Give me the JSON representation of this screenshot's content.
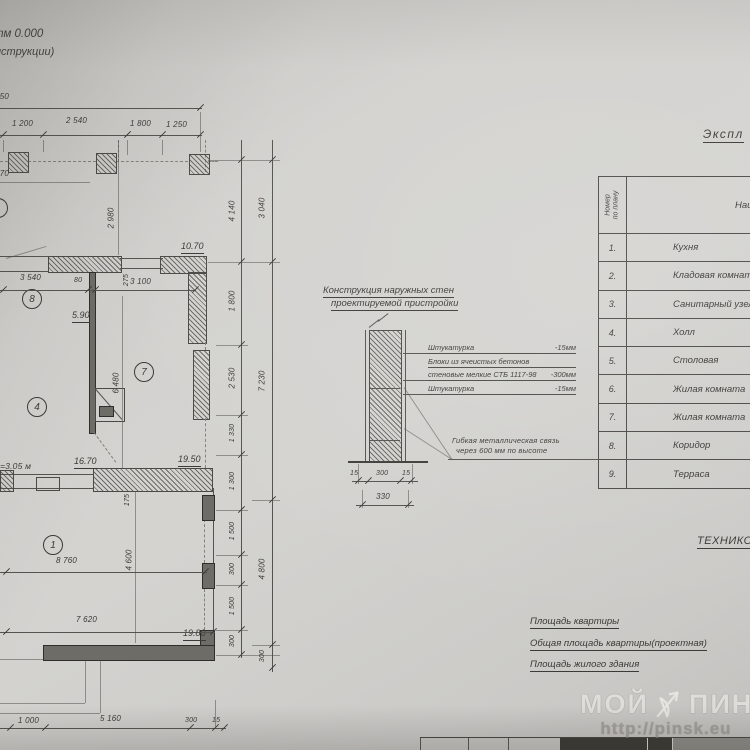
{
  "plan": {
    "elev_line1": "тм 0.000",
    "elev_line2": "нструкции)",
    "height_note": "=3.05 м",
    "rooms": {
      "r8": "8",
      "r4": "4",
      "r7": "7",
      "r1": "1"
    },
    "areas": {
      "room_top": "10.70",
      "room8": "5.90",
      "room4": "16.70",
      "room7": "19.50",
      "room1": "19.80"
    },
    "dims": {
      "top_total": "1 950",
      "top_1": "1 200",
      "top_2": "2 540",
      "top_3": "1 800",
      "top_4": "1 250",
      "left_total": "11 770",
      "w1": "3 540",
      "w2": "80",
      "w3": "3 100",
      "v1": "2 980",
      "v2": "275",
      "v3": "6 480",
      "v4": "175",
      "v5": "4 600",
      "h1": "8 760",
      "h2": "7 620",
      "b1": "1 000",
      "b2": "5 160",
      "b3": "300",
      "b4": "15",
      "r1": "4 140",
      "r2": "1 800",
      "r3": "2 530",
      "r4": "1 330",
      "r5": "1 300",
      "r6": "1 500",
      "r7": "300",
      "r8": "1 500",
      "r9": "300",
      "o1": "3 040",
      "o2": "7 230",
      "o3": "4 800",
      "o4": "300"
    }
  },
  "wall_detail": {
    "title_line1": "Конструкция наружных стен",
    "title_line2": "проектируемой пристройки",
    "layers": [
      {
        "name": "Штукатурка",
        "value": "-15мм"
      },
      {
        "name": "Блоки из ячеистых бетонов",
        "value": ""
      },
      {
        "name": "стеновые мелкие СТБ 1117-98",
        "value": "-300мм"
      },
      {
        "name": "Штукатурка",
        "value": "-15мм"
      }
    ],
    "note_line1": "Гибкая металлическая связь",
    "note_line2": "через 600 мм по высоте",
    "dims": {
      "left": "15",
      "mid": "300",
      "right": "15",
      "total": "330"
    }
  },
  "explication": {
    "title": "Экспл",
    "num_header_line1": "Номер",
    "num_header_line2": "по плану",
    "name_header": "Наимен",
    "rows": [
      {
        "num": "1.",
        "name": "Кухня"
      },
      {
        "num": "2.",
        "name": "Кладовая комната"
      },
      {
        "num": "3.",
        "name": "Санитарный узел"
      },
      {
        "num": "4.",
        "name": "Холл"
      },
      {
        "num": "5.",
        "name": "Столовая"
      },
      {
        "num": "6.",
        "name": "Жилая комната"
      },
      {
        "num": "7.",
        "name": "Жилая комната"
      },
      {
        "num": "8.",
        "name": "Коридор"
      },
      {
        "num": "9.",
        "name": "Терраса"
      }
    ]
  },
  "tech": {
    "title": "ТЕХНИКО-",
    "line1": "Площадь квартиры",
    "line2": "Общая площадь квартиры(проектная)",
    "line3": "Площадь жилого здания"
  },
  "watermark": {
    "brand_left": "МОЙ",
    "brand_right": "ПИНСК",
    "url": "http://pinsk.eu"
  }
}
